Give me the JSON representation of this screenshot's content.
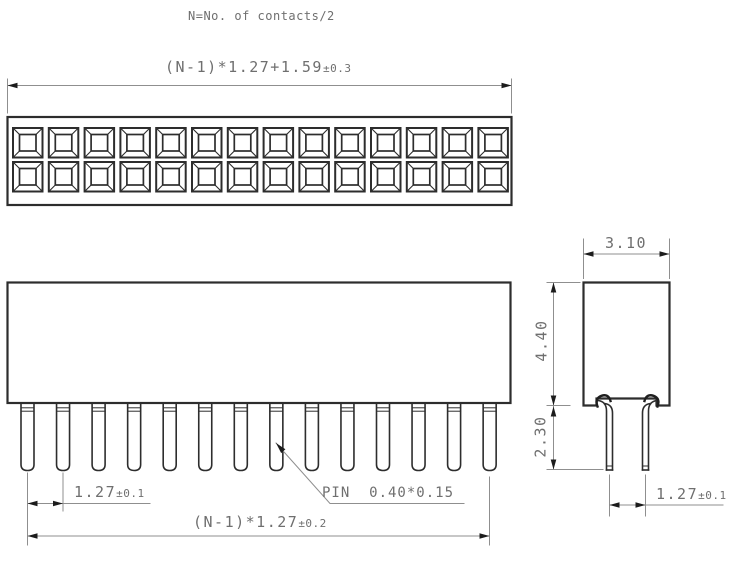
{
  "note": "N=No. of contacts/2",
  "top_view": {
    "hole_columns": 14,
    "hole_rows": 2,
    "dim_width": {
      "value": "(N-1)*1.27+1.59",
      "tolerance": "±0.3"
    }
  },
  "front_view": {
    "pin_count": 14,
    "dim_pitch": {
      "value": "1.27",
      "tolerance": "±0.1"
    },
    "pin_label": "PIN  0.40*0.15",
    "dim_total": {
      "value": "(N-1)*1.27",
      "tolerance": "±0.2"
    }
  },
  "side_view": {
    "dim_width": "3.10",
    "dim_body_height": "4.40",
    "dim_pin_length": "2.30",
    "dim_pitch": {
      "value": "1.27",
      "tolerance": "±0.1"
    }
  },
  "colors": {
    "outline": "#2d2d2d",
    "dimension": "#8f8f8f",
    "arrow": "#1c1c1c",
    "text": "#6f6f6f"
  }
}
